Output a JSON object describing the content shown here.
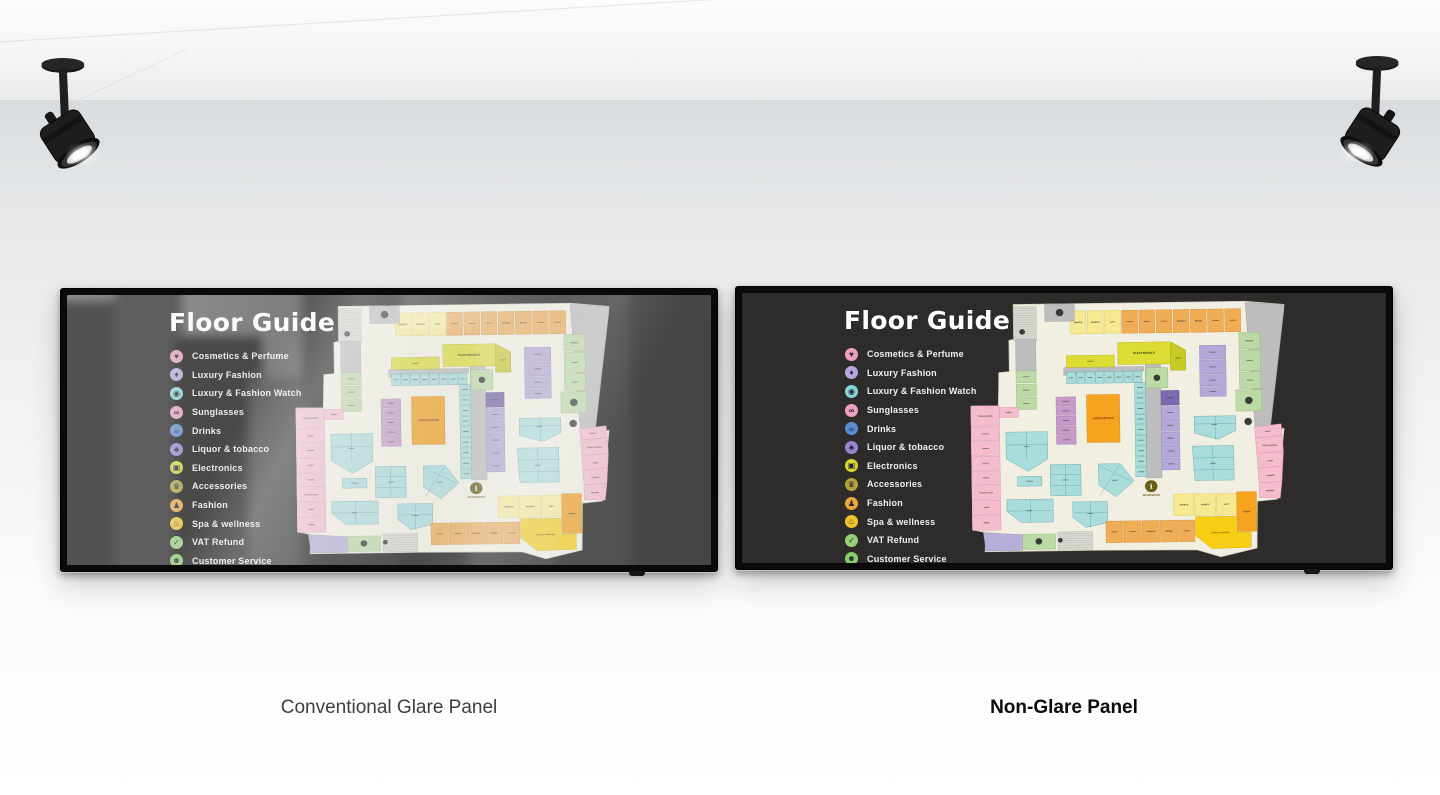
{
  "scene": {
    "captions": {
      "left": "Conventional Glare Panel",
      "right": "Non-Glare Panel"
    }
  },
  "screen": {
    "title": "Floor Guide",
    "legend": {
      "items": [
        {
          "label": "Cosmetics & Perfume",
          "color": "#ef9fc0",
          "glyph": "♥",
          "icon": "cosmetics-perfume-icon"
        },
        {
          "label": "Luxury Fashion",
          "color": "#b9a6de",
          "glyph": "♦",
          "icon": "luxury-fashion-icon"
        },
        {
          "label": "Luxury & Fashion Watch",
          "color": "#86d8d8",
          "glyph": "◉",
          "icon": "luxury-fashion-watch-icon"
        },
        {
          "label": "Sunglasses",
          "color": "#ee9fc4",
          "glyph": "∞",
          "icon": "sunglasses-icon"
        },
        {
          "label": "Drinks",
          "color": "#5a8ed2",
          "glyph": "☕",
          "icon": "drinks-icon"
        },
        {
          "label": "Liquor & tobacco",
          "color": "#9b82d2",
          "glyph": "♣",
          "icon": "liquor-tobacco-icon"
        },
        {
          "label": "Electronics",
          "color": "#d6d830",
          "glyph": "▣",
          "icon": "electronics-icon"
        },
        {
          "label": "Accessories",
          "color": "#b3a238",
          "glyph": "♛",
          "icon": "accessories-icon"
        },
        {
          "label": "Fashion",
          "color": "#eca63c",
          "glyph": "♟",
          "icon": "fashion-icon"
        },
        {
          "label": "Spa & wellness",
          "color": "#f1c22e",
          "glyph": "♨",
          "icon": "spa-wellness-icon"
        },
        {
          "label": "VAT Refund",
          "color": "#95cf78",
          "glyph": "✓",
          "icon": "vat-refund-icon"
        },
        {
          "label": "Customer Service",
          "color": "#87cf68",
          "glyph": "☻",
          "icon": "customer-service-icon"
        }
      ]
    },
    "map": {
      "floor": {
        "fill": "#f0efe2",
        "stroke": "#cfccb8"
      },
      "outline": "92,2 578,2 660,10 626,286 656,280 640,434 598,438 596,540 520,558 470,542 252,540 108,540 26,540 28,498 0,492 0,222 58,222 60,150 82,148 82,80 92,78",
      "palette": {
        "O": [
          "#f1ad55",
          "#cd8a33"
        ],
        "Y": [
          "#f6e992",
          "#d8c75a"
        ],
        "G": [
          "#dcdc33",
          "#b4b421"
        ],
        "g": [
          "#c9ca25",
          "#a3a418"
        ],
        "T": [
          "#abdcdc",
          "#5fa8a8"
        ],
        "P": [
          "#f5bccd",
          "#d792ad"
        ],
        "M": [
          "#c69bcb",
          "#a377ab"
        ],
        "L": [
          "#b5a7d8",
          "#9183bb"
        ],
        "D": [
          "#7c69b0",
          "#5d4d8e"
        ],
        "N": [
          "#bcdaa5",
          "#93b878"
        ],
        "C": [
          "#bdbdbd",
          "#9e9e9e"
        ],
        "B": [
          "#f8ce14",
          "#d3a900"
        ],
        "R": [
          "#f6a41f",
          "#d07f07"
        ],
        "V": [
          "#b7aeda",
          "#958cbd"
        ]
      },
      "hatches": [
        [
          92,
          7,
          48,
          74
        ],
        [
          179,
          499,
          73,
          39
        ]
      ],
      "polys": [
        [
          "578,4 660,10 626,286 596,286",
          "C",
          null
        ],
        [
          "420,88 452,106 452,150 420,150",
          "g",
          ""
        ],
        [
          "196,141 364,141 364,150 196,158",
          "C",
          null
        ],
        [
          "73,280 160,280 160,340 118,366 73,338",
          "T",
          "",
          116,
          312
        ],
        [
          "165,352 229,352 229,420 165,420",
          "T",
          "",
          197,
          386
        ],
        [
          "266,352 312,352 340,390 302,424 266,398",
          "T",
          "",
          300,
          388
        ],
        [
          "73,427 170,427 170,477 102,477 73,453",
          "T",
          "",
          120,
          452
        ],
        [
          "211,434 284,434 284,480 238,490 211,468",
          "T",
          "",
          247,
          460
        ],
        [
          "468,251 555,251 555,283 518,302 468,288",
          "T",
          "",
          510,
          270
        ],
        [
          "463,316 550,316 550,391 468,391",
          "T",
          "",
          506,
          354
        ],
        [
          "594,276 650,270 652,296 596,300",
          "P",
          "",
          622,
          286
        ],
        [
          "596,300 652,296 654,330 598,334",
          "P",
          "TAKIDA WARRIOR",
          625,
          316,
          3.2
        ],
        [
          "598,334 654,330 652,362 600,366",
          "P",
          "LUXE",
          626,
          350,
          3.8
        ],
        [
          "600,366 652,362 650,396 602,398",
          "P",
          "SPORTS",
          626,
          382,
          3.8
        ],
        [
          "602,398 650,396 646,432 602,430",
          "P",
          "WOMEN",
          625,
          415,
          3.8
        ],
        [
          "468,470 553,470 553,505 584,505 584,538 502,540 468,512",
          "B",
          "TAKIDA WARRIOR",
          520,
          505,
          4,
          "#7a6108"
        ],
        [
          "23,498 105,504 105,538 28,538",
          "V",
          null
        ]
      ],
      "rects": [
        [
          211,
          18,
          33,
          50,
          "Y",
          "SPORTS"
        ],
        [
          247,
          18,
          33,
          50,
          "Y",
          "SPORTS"
        ],
        [
          283,
          18,
          33,
          50,
          "Y",
          "LIFT"
        ],
        [
          319,
          18,
          33,
          50,
          "O",
          ""
        ],
        [
          355,
          18,
          33,
          50,
          "O",
          ""
        ],
        [
          391,
          18,
          33,
          50,
          "O",
          ""
        ],
        [
          427,
          18,
          33,
          50,
          "O",
          "SPORTS"
        ],
        [
          463,
          18,
          33,
          50,
          "O",
          "ROOM"
        ],
        [
          499,
          18,
          33,
          50,
          "O",
          ""
        ],
        [
          535,
          18,
          33,
          50,
          "O",
          ""
        ],
        [
          564,
          70,
          44,
          36,
          "N",
          "SPORTS",
          3.8
        ],
        [
          564,
          109,
          44,
          44,
          "N",
          ""
        ],
        [
          564,
          156,
          44,
          36,
          "N",
          ""
        ],
        [
          556,
          195,
          54,
          46,
          "N",
          null
        ],
        [
          158,
          2,
          62,
          38,
          "C",
          null
        ],
        [
          96,
          79,
          42,
          68,
          "C",
          null
        ],
        [
          367,
          136,
          32,
          248,
          "C",
          null
        ],
        [
          202,
          115,
          100,
          26,
          "G",
          ""
        ],
        [
          310,
          88,
          110,
          48,
          "G",
          "ELECTRONICS",
          6,
          "#4f4d14"
        ],
        [
          368,
          144,
          46,
          44,
          "N",
          null
        ],
        [
          202,
          151,
          18,
          25,
          "T",
          ""
        ],
        [
          222,
          151,
          18,
          25,
          "T",
          ""
        ],
        [
          242,
          151,
          18,
          25,
          "T",
          ""
        ],
        [
          262,
          151,
          18,
          25,
          "T",
          ""
        ],
        [
          282,
          151,
          18,
          25,
          "T",
          ""
        ],
        [
          302,
          151,
          18,
          25,
          "T",
          ""
        ],
        [
          322,
          151,
          18,
          25,
          "T",
          ""
        ],
        [
          342,
          151,
          18,
          25,
          "T",
          ""
        ],
        [
          344,
          176,
          23,
          21,
          "T",
          ""
        ],
        [
          344,
          199,
          23,
          21,
          "T",
          ""
        ],
        [
          344,
          222,
          23,
          21,
          "T",
          ""
        ],
        [
          344,
          245,
          23,
          21,
          "T",
          ""
        ],
        [
          344,
          268,
          23,
          21,
          "T",
          ""
        ],
        [
          344,
          291,
          23,
          21,
          "T",
          ""
        ],
        [
          344,
          314,
          23,
          21,
          "T",
          ""
        ],
        [
          344,
          337,
          23,
          21,
          "T",
          ""
        ],
        [
          344,
          360,
          23,
          21,
          "T",
          ""
        ],
        [
          399,
          194,
          38,
          32,
          "D",
          ""
        ],
        [
          399,
          229,
          38,
          26,
          "L",
          ""
        ],
        [
          399,
          257,
          38,
          26,
          "L",
          ""
        ],
        [
          399,
          285,
          38,
          26,
          "L",
          ""
        ],
        [
          399,
          313,
          38,
          26,
          "L",
          ""
        ],
        [
          399,
          341,
          38,
          26,
          "L",
          ""
        ],
        [
          481,
          97,
          55,
          30,
          "L",
          ""
        ],
        [
          481,
          129,
          55,
          30,
          "L",
          ""
        ],
        [
          481,
          161,
          55,
          24,
          "L",
          ""
        ],
        [
          481,
          187,
          55,
          21,
          "L",
          ""
        ],
        [
          179,
          205,
          41,
          19,
          "M",
          ""
        ],
        [
          179,
          226,
          41,
          19,
          "M",
          ""
        ],
        [
          179,
          247,
          41,
          19,
          "M",
          ""
        ],
        [
          179,
          268,
          41,
          19,
          "M",
          ""
        ],
        [
          179,
          289,
          41,
          19,
          "M",
          ""
        ],
        [
          243,
          201,
          69,
          104,
          "R",
          "CONVENTION",
          6,
          "#8f3f10"
        ],
        [
          96,
          147,
          42,
          26,
          "N",
          ""
        ],
        [
          96,
          176,
          42,
          26,
          "N",
          ""
        ],
        [
          96,
          205,
          42,
          26,
          "N",
          ""
        ],
        [
          60,
          226,
          40,
          22,
          "P",
          "MART",
          3.8
        ],
        [
          0,
          222,
          60,
          44,
          "P",
          "TAKIDA WARRIOR",
          3.2
        ],
        [
          0,
          268,
          60,
          30,
          "P",
          ""
        ],
        [
          0,
          300,
          60,
          30,
          "P",
          ""
        ],
        [
          0,
          332,
          60,
          30,
          "P",
          ""
        ],
        [
          0,
          364,
          60,
          30,
          "P",
          ""
        ],
        [
          0,
          396,
          60,
          30,
          "P",
          "THE BATH SHOP",
          3.2
        ],
        [
          0,
          428,
          60,
          30,
          "P",
          "LARA",
          3.8
        ],
        [
          0,
          460,
          60,
          33,
          "P",
          "PUMA",
          3.8
        ],
        [
          96,
          377,
          51,
          21,
          "T",
          ""
        ],
        [
          422,
          420,
          43,
          47,
          "Y",
          "SPORTS"
        ],
        [
          467,
          420,
          43,
          47,
          "Y",
          "SPORTS"
        ],
        [
          512,
          420,
          43,
          47,
          "Y",
          "LIFT"
        ],
        [
          555,
          417,
          41,
          86,
          "R",
          "ROOM"
        ],
        [
          280,
          477,
          36,
          47,
          "O",
          ""
        ],
        [
          318,
          477,
          36,
          47,
          "O",
          ""
        ],
        [
          356,
          477,
          36,
          47,
          "O",
          "SPORTS"
        ],
        [
          394,
          477,
          36,
          47,
          "O",
          "ROOM"
        ],
        [
          432,
          477,
          34,
          47,
          "O",
          ""
        ],
        [
          105,
          503,
          69,
          33,
          "N",
          null
        ]
      ],
      "lines": [
        [
          73,
          308,
          160,
          308
        ],
        [
          116,
          280,
          116,
          340
        ],
        [
          165,
          374,
          229,
          374
        ],
        [
          165,
          398,
          229,
          398
        ],
        [
          197,
          352,
          197,
          420
        ],
        [
          268,
          356,
          334,
          390
        ],
        [
          310,
          354,
          270,
          418
        ],
        [
          73,
          452,
          170,
          452
        ],
        [
          122,
          427,
          122,
          477
        ],
        [
          211,
          458,
          284,
          458
        ],
        [
          248,
          434,
          248,
          490
        ],
        [
          468,
          268,
          555,
          268
        ],
        [
          512,
          251,
          512,
          302
        ],
        [
          463,
          342,
          550,
          342
        ],
        [
          463,
          368,
          550,
          368
        ],
        [
          506,
          316,
          506,
          391
        ]
      ],
      "circles": [
        [
          189,
          21,
          8
        ],
        [
          110,
          62,
          6
        ],
        [
          391,
          166,
          7
        ],
        [
          583,
          218,
          8
        ],
        [
          581,
          264,
          8
        ],
        [
          139,
          519,
          7
        ],
        [
          184,
          517,
          5
        ]
      ],
      "info": {
        "x": 376,
        "y": 402,
        "r": 13,
        "glyph": "i",
        "label": "INFORMATION"
      }
    }
  }
}
